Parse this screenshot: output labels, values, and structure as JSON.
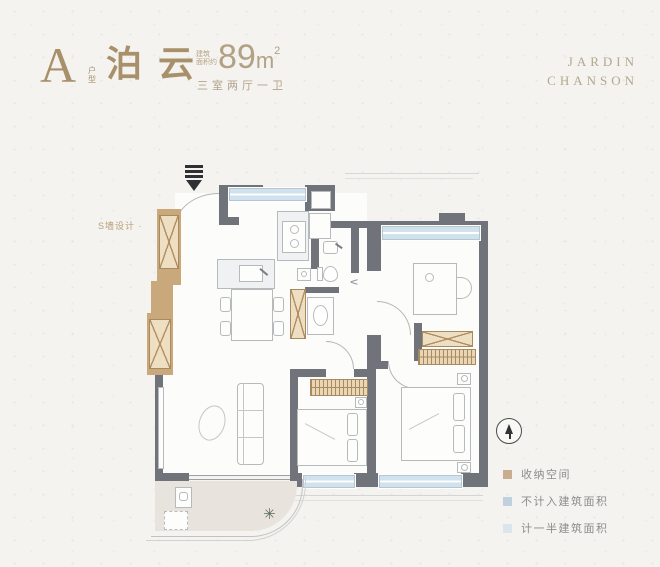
{
  "header": {
    "type_letter": "A",
    "type_label": "户型",
    "name": "泊云",
    "area_note": [
      "建筑",
      "面积约"
    ],
    "area_value": "89",
    "area_unit": "m",
    "area_exponent": "2",
    "rooms": "三室两厅一卫"
  },
  "brand": {
    "line1": "JARDIN",
    "line2": "CHANSON"
  },
  "plan_note": "S墙设计 ·",
  "legend": {
    "items": [
      {
        "label": "收纳空间",
        "color": "#c9ad8f"
      },
      {
        "label": "不计入建筑面积",
        "color": "#bfd1dd"
      },
      {
        "label": "计一半建筑面积",
        "color": "#dbe6ec"
      }
    ]
  },
  "colors": {
    "background": "#f4f3f0",
    "accent_gold": "#a8906a",
    "brand_gold": "#b3a88e",
    "wall": "#70747a",
    "window_blue": "#cfe2ee",
    "storage_fill": "#efdfc2",
    "storage_line": "#b08f62",
    "balcony_floor": "#e8e4dd",
    "legend_text": "#8c8c8c"
  }
}
